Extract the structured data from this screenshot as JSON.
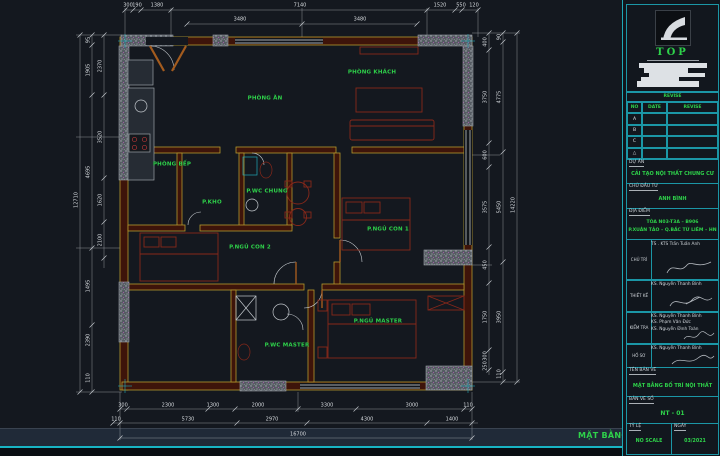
{
  "colors": {
    "background": "#14181f",
    "accent_cyan": "#1fa7b5",
    "text_green": "#2ed24a",
    "dim_white": "#d5d9dd",
    "wall_yellow": "#b5992e",
    "furniture_red": "#87281a"
  },
  "plan": {
    "rooms": [
      {
        "label": "PHÒNG KHÁCH",
        "x": 372,
        "y": 73
      },
      {
        "label": "PHÒNG ĂN",
        "x": 265,
        "y": 99
      },
      {
        "label": "PHÒNG BẾP",
        "x": 172,
        "y": 165
      },
      {
        "label": "P.KHO",
        "x": 212,
        "y": 203
      },
      {
        "label": "P.WC CHUNG",
        "x": 267,
        "y": 192
      },
      {
        "label": "P.NGỦ CON 2",
        "x": 250,
        "y": 248
      },
      {
        "label": "P.NGỦ CON 1",
        "x": 388,
        "y": 230
      },
      {
        "label": "P.NGỦ MASTER",
        "x": 378,
        "y": 322
      },
      {
        "label": "P.WC MASTER",
        "x": 287,
        "y": 346
      }
    ],
    "dim_labels": [
      {
        "t": "300",
        "x": 128,
        "y": 6
      },
      {
        "t": "190",
        "x": 137,
        "y": 6
      },
      {
        "t": "1380",
        "x": 157,
        "y": 6
      },
      {
        "t": "7140",
        "x": 300,
        "y": 6
      },
      {
        "t": "1520",
        "x": 440,
        "y": 6
      },
      {
        "t": "550",
        "x": 461,
        "y": 6
      },
      {
        "t": "120",
        "x": 474,
        "y": 6
      },
      {
        "t": "3480",
        "x": 240,
        "y": 20
      },
      {
        "t": "3480",
        "x": 360,
        "y": 20
      },
      {
        "t": "12710",
        "x": 77,
        "y": 200,
        "r": 1
      },
      {
        "t": "95",
        "x": 89,
        "y": 40,
        "r": 1
      },
      {
        "t": "1905",
        "x": 89,
        "y": 70,
        "r": 1
      },
      {
        "t": "4695",
        "x": 89,
        "y": 172,
        "r": 1
      },
      {
        "t": "1495",
        "x": 89,
        "y": 286,
        "r": 1
      },
      {
        "t": "2390",
        "x": 89,
        "y": 340,
        "r": 1
      },
      {
        "t": "110",
        "x": 89,
        "y": 378,
        "r": 1
      },
      {
        "t": "2370",
        "x": 101,
        "y": 66,
        "r": 1
      },
      {
        "t": "3520",
        "x": 101,
        "y": 137,
        "r": 1
      },
      {
        "t": "1620",
        "x": 101,
        "y": 200,
        "r": 1
      },
      {
        "t": "2100",
        "x": 101,
        "y": 240,
        "r": 1
      },
      {
        "t": "400",
        "x": 486,
        "y": 42,
        "r": 1
      },
      {
        "t": "3750",
        "x": 486,
        "y": 97,
        "r": 1
      },
      {
        "t": "600",
        "x": 486,
        "y": 155,
        "r": 1
      },
      {
        "t": "3575",
        "x": 486,
        "y": 207,
        "r": 1
      },
      {
        "t": "450",
        "x": 486,
        "y": 265,
        "r": 1
      },
      {
        "t": "1750",
        "x": 486,
        "y": 317,
        "r": 1
      },
      {
        "t": "300",
        "x": 486,
        "y": 356,
        "r": 1
      },
      {
        "t": "250",
        "x": 486,
        "y": 366,
        "r": 1
      },
      {
        "t": "90",
        "x": 500,
        "y": 37,
        "r": 1
      },
      {
        "t": "4775",
        "x": 500,
        "y": 97,
        "r": 1
      },
      {
        "t": "5450",
        "x": 500,
        "y": 207,
        "r": 1
      },
      {
        "t": "3950",
        "x": 500,
        "y": 317,
        "r": 1
      },
      {
        "t": "110",
        "x": 500,
        "y": 374,
        "r": 1
      },
      {
        "t": "14220",
        "x": 514,
        "y": 205,
        "r": 1
      },
      {
        "t": "300",
        "x": 123,
        "y": 406
      },
      {
        "t": "2300",
        "x": 168,
        "y": 406
      },
      {
        "t": "1300",
        "x": 213,
        "y": 406
      },
      {
        "t": "2000",
        "x": 258,
        "y": 406
      },
      {
        "t": "3300",
        "x": 327,
        "y": 406
      },
      {
        "t": "3000",
        "x": 412,
        "y": 406
      },
      {
        "t": "110",
        "x": 468,
        "y": 406
      },
      {
        "t": "110",
        "x": 116,
        "y": 420
      },
      {
        "t": "5730",
        "x": 188,
        "y": 420
      },
      {
        "t": "2970",
        "x": 272,
        "y": 420
      },
      {
        "t": "4300",
        "x": 367,
        "y": 420
      },
      {
        "t": "1400",
        "x": 452,
        "y": 420
      },
      {
        "t": "16700",
        "x": 298,
        "y": 435
      }
    ]
  },
  "titleblock": {
    "logo_text": "TOP",
    "revision_header": "REVISE",
    "rev_cols": [
      "NO",
      "DATE",
      "REVISE"
    ],
    "rev_rows": [
      "A",
      "B",
      "C",
      "△"
    ],
    "project_label": "DỰ ÁN",
    "project": "CẢI TẠO NỘI THẤT CHUNG CƯ",
    "client_label": "CHỦ ĐẦU TƯ",
    "client": "ANH BÌNH",
    "location_label": "ĐỊA ĐIỂM",
    "location_line1": "TÒA N03-T3A – B906",
    "location_line2": "P.XUÂN TẢO – Q.BẮC TỪ LIÊM – HN",
    "people": [
      {
        "role": "CHỦ TRÌ",
        "names": [
          "TS . KTS Trần Tuấn Anh"
        ]
      },
      {
        "role": "THIẾT KẾ",
        "names": [
          "KS. Nguyễn Thanh Bình"
        ]
      },
      {
        "role": "KIỂM TRA",
        "names": [
          "KS. Nguyễn Thanh Bình",
          "KS. Phạm Văn Đức",
          "KS. Nguyễn Đình Toàn"
        ]
      },
      {
        "role": "HỒ SƠ",
        "names": [
          "KS. Nguyễn Thanh Bình"
        ]
      }
    ],
    "drawing_label": "TÊN BẢN VẼ",
    "drawing_name": "MẶT BẰNG BỐ TRÍ NỘI THẤT",
    "sheet_label": "BẢN VẼ SỐ",
    "sheet_no": "NT - 01",
    "scale_label": "TỶ LỆ",
    "scale_value": "NO SCALE",
    "date_label": "NGÀY",
    "date_value": "03/2021"
  },
  "footer": {
    "title": "MẶT BẰNG BỐ TRÍ NỘI THẤT"
  }
}
